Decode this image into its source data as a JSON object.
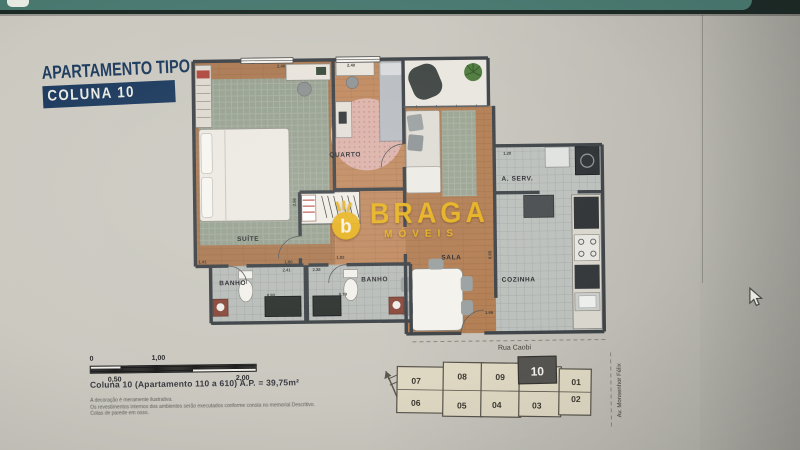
{
  "page": {
    "title_line1": "APARTAMENTO TIPO",
    "title_line2": "COLUNA 10"
  },
  "floorplan": {
    "rooms": {
      "suite": "SUÍTE",
      "quarto": "QUARTO",
      "sala": "SALA",
      "banho_left": "BANHO",
      "banho_right": "BANHO",
      "cozinha": "COZINHA",
      "area_servico": "A. SERV."
    },
    "dimensions": {
      "suite_top": "2.40",
      "quarto_top": "2.40",
      "suite_side": "3.56",
      "closet": "1.90",
      "suite_bottom_left": "1.41",
      "hall_right": "1.83",
      "banho_left_width": "2.41",
      "banho_right_width": "2.38",
      "banho_left_depth": "0.90",
      "banho_right_depth": "0.79",
      "area_servico_width": "1.20",
      "cozinha_height": "6.65",
      "cozinha_bottom": "1.66"
    }
  },
  "watermark": {
    "brand": "BRAGA",
    "subtitle": "MÓVEIS",
    "icon_letter": "b",
    "color": "#e9b41f"
  },
  "scale_bar": {
    "tick_0": "0",
    "tick_050": "0,50",
    "tick_100": "1,00",
    "tick_200": "2,00"
  },
  "caption": {
    "line": "Coluna 10 (Apartamento 110 a 610) A.P. = 39,75m²",
    "disclaimer_1": "A decoração é meramente ilustrativa.",
    "disclaimer_2": "Os revestimentos internos dos ambientes serão executados conforme consta no memorial Descritivo.",
    "disclaimer_3": "Cotas de parede em osso."
  },
  "keyplan": {
    "street_top": "Rua Caobi",
    "street_right": "Av. Monsenhor Félix",
    "highlighted_unit": "10",
    "units_top": [
      "07",
      "08",
      "09",
      "10",
      "01"
    ],
    "units_bottom": [
      "06",
      "05",
      "04",
      "03",
      "02"
    ]
  },
  "colors": {
    "title_navy": "#1c3a5e",
    "logo_yellow": "#e9b41f",
    "bezel_teal": "#4a7a71",
    "bezel_dark": "#1d2b27",
    "keyplan_highlight": "#555450"
  }
}
